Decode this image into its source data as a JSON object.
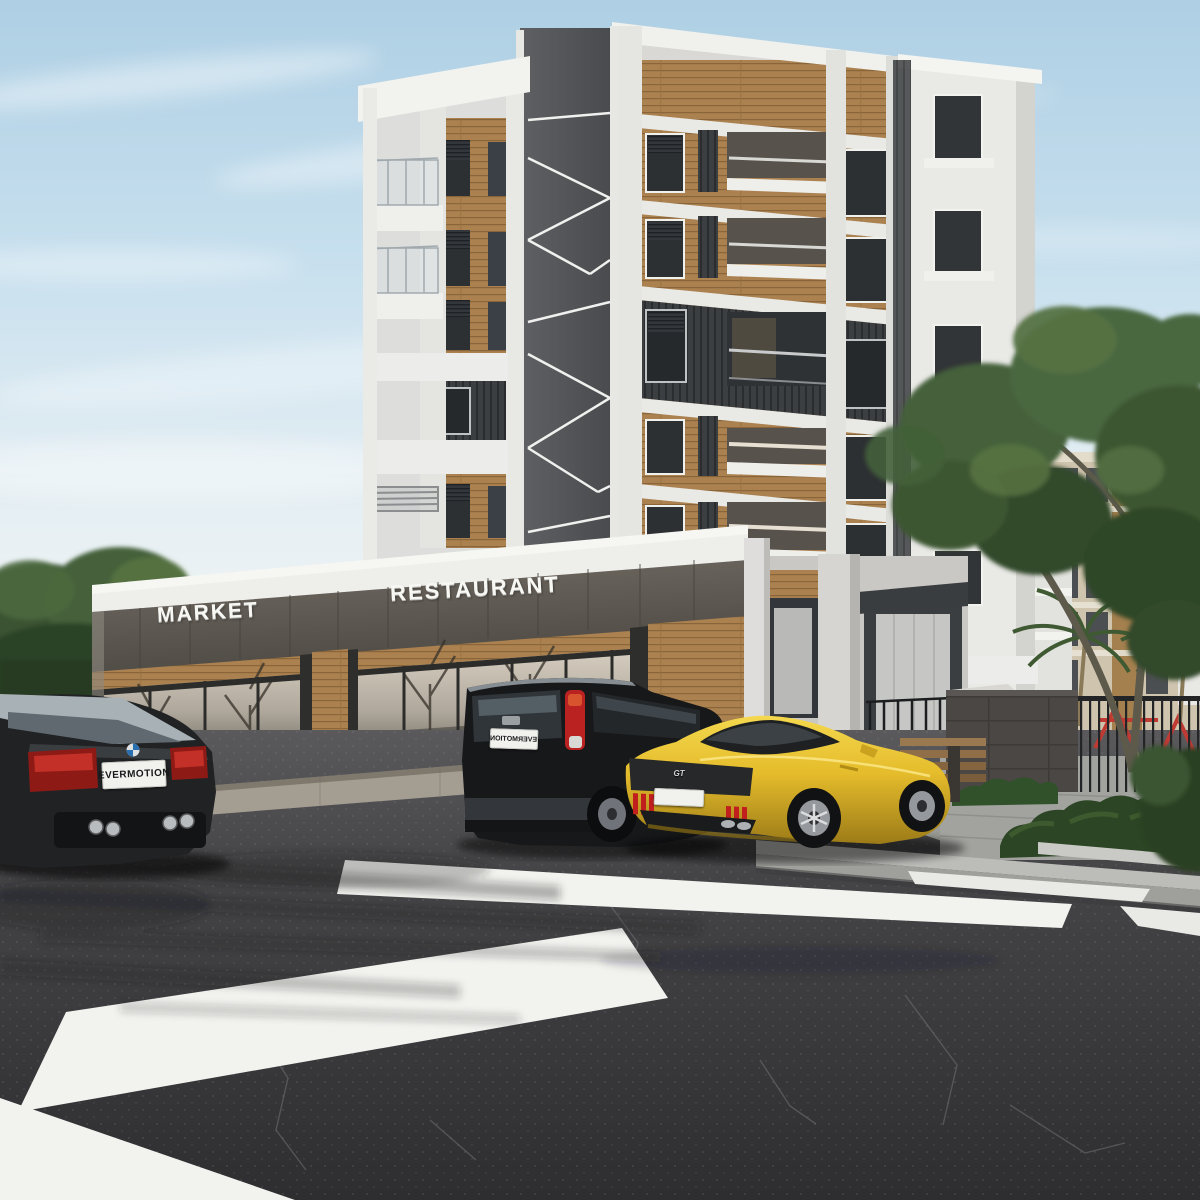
{
  "scene": {
    "description": "3D architectural exterior rendering: modern apartment block with ground-floor MARKET and RESTAURANT shops, parked cars and a zebra crosswalk",
    "signs": {
      "market": "MARKET",
      "restaurant": "RESTAURANT"
    },
    "vehicles": {
      "coupe": {
        "type": "black coupe",
        "plate": "EVERMOTION"
      },
      "suv": {
        "type": "black SUV",
        "plate": "EVERMOTION"
      },
      "sports_car": {
        "type": "yellow sports car",
        "badge": "GT"
      }
    },
    "palette": {
      "sky_top": "#aecfe4",
      "sky_mid": "#cde2ee",
      "sky_horizon": "#ecf2f4",
      "concrete": "#e8e8e4",
      "concrete_shade": "#d6d6d1",
      "wood": "#ab8150",
      "wood_dark": "#8a6539",
      "core_dark": "#55575a",
      "fascia_top": "#716b63",
      "fascia_bottom": "#4e4a44",
      "glass_warm": "#d8cfc2",
      "asphalt": "#454547",
      "asphalt_dark": "#2e2e30",
      "stripe": "#f2f2ef",
      "sidewalk": "#b4b5b1",
      "pavement": "#a2a39f",
      "wall": "#4b4744",
      "hedge": "#2c4525",
      "hedge_light": "#3f5c31",
      "tree": "#44603a",
      "tree_dark": "#32492a",
      "tree_light": "#5a7544",
      "mustang_yellow": "#e5bc2b",
      "car_black": "#1d1f21",
      "taillight_red": "#b42220",
      "plate_white": "#f1f1ee"
    }
  }
}
